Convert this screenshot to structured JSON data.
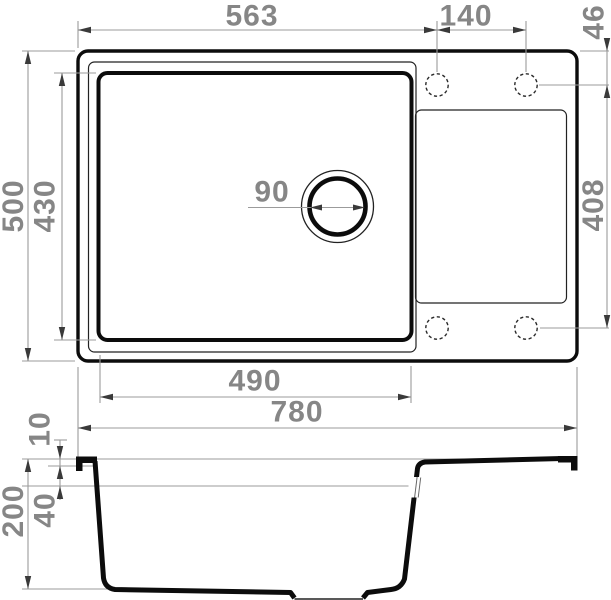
{
  "drawing_type": "kitchen sink installation diagram (top view and section view)",
  "colors": {
    "background": "#ffffff",
    "outline": "#0c0c0c",
    "thin_line": "#222222",
    "dimension_line": "#9b9b9b",
    "arrowhead": "#3a3a3a",
    "label": "#868686"
  },
  "top_view": {
    "description": "rectangular sink with left bowl, right drainboard, drain hole and four dashed tap holes",
    "labels": {
      "tap_hole_offset_x": "563",
      "tap_hole_spacing": "140",
      "tap_hole_edge_offset": "46",
      "overall_depth": "500",
      "bowl_depth": "430",
      "tap_hole_span": "408",
      "drain_diameter": "90",
      "bowl_width": "490",
      "overall_width": "780"
    }
  },
  "side_view": {
    "description": "cross-section of bowl with drain recess and sloped drainboard",
    "labels": {
      "rim_thickness": "10",
      "drainboard_drop": "40",
      "overall_height": "200"
    }
  }
}
